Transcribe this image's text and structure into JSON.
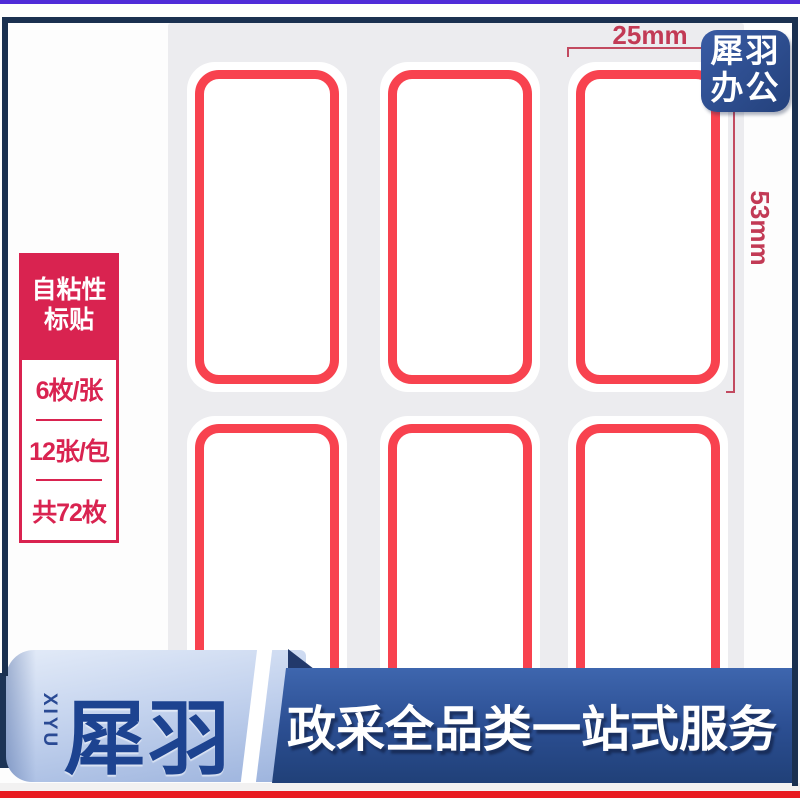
{
  "dimensions": {
    "width_label": "25mm",
    "height_label": "53mm"
  },
  "badge": {
    "lines": [
      "犀羽",
      "办公"
    ]
  },
  "info_box": {
    "title_lines": [
      "自粘性",
      "标贴"
    ],
    "specs": [
      "6枚/张",
      "12张/包",
      "共72枚"
    ]
  },
  "label_sheet": {
    "rows": 2,
    "columns": 3
  },
  "banner": {
    "brand_vertical": "XIYU",
    "brand": "犀羽",
    "slogan": "政采全品类一站式服务"
  },
  "colors": {
    "label_border_red": "#f8424f",
    "sheet_gray": "#ececef",
    "spec_crimson": "#d92350",
    "dimension_red": "#c23a55",
    "badge_blue": "#2d4d8e",
    "ribbon_light_blue": "#c4d3ee",
    "slogan_dark_blue": "#2c4f93",
    "brand_navy": "#1d4390",
    "frame_purple": "#4f2bd8",
    "frame_navy": "#1a3050",
    "frame_red": "#e8191f"
  }
}
